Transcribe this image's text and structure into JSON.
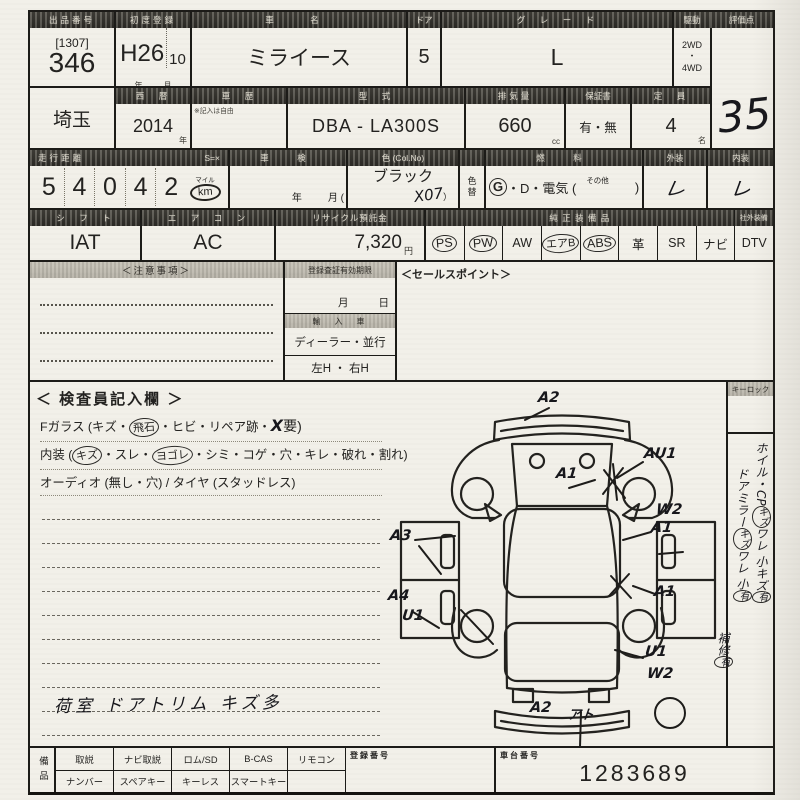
{
  "labels": {
    "lot_header": "出品番号",
    "first_reg": "初度登録",
    "car_name": "車　名",
    "door": "ドア",
    "grade": "グ　レ　ー　ド",
    "drive": "駆動",
    "score": "評価点",
    "year_west": "西　暦",
    "history": "車　歴",
    "history_note": "※記入は自由",
    "model": "型　式",
    "displacement": "排気量",
    "warranty": "保証書",
    "capacity": "定　員",
    "mileage": "走行距離",
    "mileage_s": "S=×",
    "shaken": "車　検",
    "color": "色 (Col.No)",
    "color_change": "色替",
    "fuel": "燃　料",
    "exterior": "外装",
    "interior": "内装",
    "shift": "シ　フ　ト",
    "aircon": "エ　ア　コ　ン",
    "recycle": "リサイクル預託金",
    "oem_equip": "純 正 装 備 品",
    "aftermarket": "社外装備",
    "caution": "＜注意事項＞",
    "expiry": "登録査証有効期限",
    "import": "輸　入　車",
    "sales_point": "＜セールスポイント＞",
    "key_lock": "キーロック",
    "reg_no": "登録番号",
    "chassis_no": "車台番号",
    "equip_col": "備品"
  },
  "vehicle": {
    "lot_bracket": "[1307]",
    "lot": "346",
    "reg_year": "H26",
    "reg_month": "10",
    "unit_year": "年",
    "unit_month": "月",
    "name": "ミライース",
    "doors": "5",
    "grade": "L",
    "drive_top": "2WD",
    "drive_dot": "・",
    "drive_bottom": "4WD",
    "score": "35",
    "region": "埼玉",
    "year": "2014",
    "model_code": "DBA - LA300S",
    "displacement": "660",
    "unit_cc": "cc",
    "warranty": "有・無",
    "capacity": "4",
    "unit_capacity": "名",
    "mileage_digits": [
      "5",
      "4",
      "0",
      "4",
      "2"
    ],
    "mileage_mile": "マイル",
    "mileage_km": "km",
    "shaken_year": "年",
    "shaken_month": "月 (",
    "color": "ブラック",
    "color_code": "X07",
    "color_code_close": "）",
    "fuel_g": "G",
    "fuel_rest": "・D・電気 (",
    "fuel_other": "その他",
    "fuel_close": ")",
    "ext_mark": "レ",
    "int_mark": "レ",
    "shift": "IAT",
    "aircon": "AC",
    "recycle_fee": "7,320",
    "unit_yen": "円"
  },
  "equipment": {
    "items": [
      {
        "label": "PS",
        "circled": true
      },
      {
        "label": "PW",
        "circled": true
      },
      {
        "label": "AW",
        "circled": false
      },
      {
        "label": "エアB",
        "circled": true
      },
      {
        "label": "ABS",
        "circled": true
      },
      {
        "label": "革",
        "circled": false
      },
      {
        "label": "SR",
        "circled": false
      },
      {
        "label": "ナビ",
        "circled": false
      }
    ],
    "dtv": "DTV"
  },
  "mid": {
    "expiry_month": "月",
    "expiry_day": "日",
    "import_type": "ディーラー・並行",
    "handle": "左H ・ 右H"
  },
  "inspector": {
    "title": "＜ 検査員記入欄 ＞",
    "l1": {
      "s0": "Fガラス (キズ・",
      "s1": "飛石",
      "s2": "・ヒビ・リペア跡・",
      "s3": "X",
      "s4": "要)"
    },
    "l2": {
      "s0": "内装 (",
      "s1": "キズ",
      "s2": "・スレ・",
      "s3": "ヨゴレ",
      "s4": "・シミ・コゲ・穴・キレ・破れ・割れ)"
    },
    "l3": {
      "s0": "オーディオ (無し・穴) / タイヤ (スタッドレス)"
    },
    "note": "荷室 ドアトリム キズ多"
  },
  "diagram": {
    "annotations": [
      {
        "t": "A2",
        "x": 150,
        "y": 8
      },
      {
        "t": "AU1",
        "x": 256,
        "y": 64
      },
      {
        "t": "A1",
        "x": 168,
        "y": 84
      },
      {
        "t": "W2",
        "x": 268,
        "y": 120
      },
      {
        "t": "A1",
        "x": 263,
        "y": 138
      },
      {
        "t": "A3",
        "x": 2,
        "y": 146
      },
      {
        "t": "A4",
        "x": 0,
        "y": 206
      },
      {
        "t": "U1",
        "x": 14,
        "y": 226
      },
      {
        "t": "A1",
        "x": 266,
        "y": 202
      },
      {
        "t": "U1",
        "x": 257,
        "y": 262
      },
      {
        "t": "W2",
        "x": 259,
        "y": 284
      },
      {
        "t": "A2",
        "x": 142,
        "y": 318
      },
      {
        "t": "アト",
        "x": 180,
        "y": 322
      }
    ]
  },
  "side": {
    "l1": {
      "s0": "ホイル・CP",
      "s1": "キズ",
      "s2": "ワレ 小キズ",
      "s3": "有"
    },
    "l2": {
      "s0": "ドアミラー",
      "s1": "キズ",
      "s2": "ワレ 小",
      "s3": "有"
    },
    "l3": {
      "s0": "補修",
      "s1": "有"
    }
  },
  "bottom": {
    "row1": [
      "取説",
      "ナビ取説",
      "ロム/SD",
      "B-CAS",
      "リモコン"
    ],
    "row2": [
      "ナンバー",
      "スペアキー",
      "キーレス",
      "スマートキー"
    ],
    "chassis_value": "1283689"
  }
}
